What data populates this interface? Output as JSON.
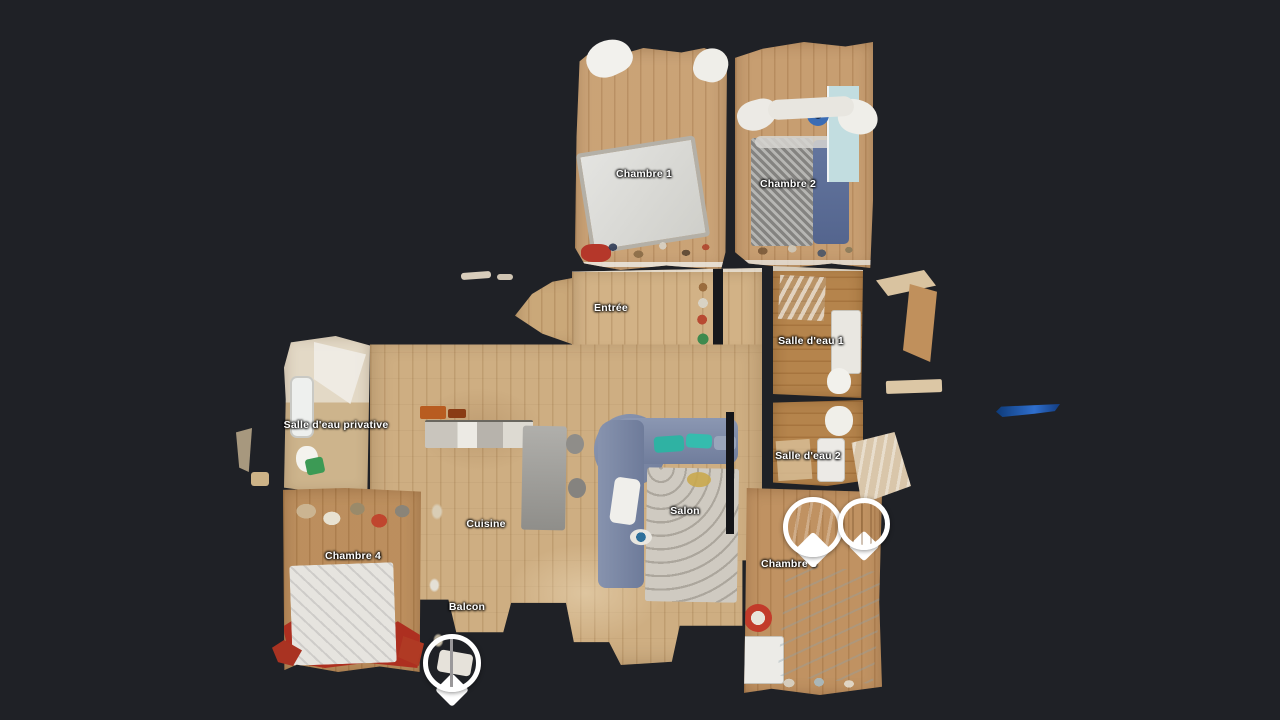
{
  "view": {
    "kind": "dollhouse-floorplan-3d-view",
    "background_color": "#1f2126"
  },
  "labels": [
    {
      "id": "chambre-1",
      "text": "Chambre 1"
    },
    {
      "id": "chambre-2",
      "text": "Chambre 2"
    },
    {
      "id": "entree",
      "text": "Entrée"
    },
    {
      "id": "salle-deau-1",
      "text": "Salle d'eau 1"
    },
    {
      "id": "salle-deau-privative",
      "text": "Salle d'eau privative"
    },
    {
      "id": "salle-deau-2",
      "text": "Salle d'eau 2"
    },
    {
      "id": "cuisine",
      "text": "Cuisine"
    },
    {
      "id": "salon",
      "text": "Salon"
    },
    {
      "id": "chambre-4",
      "text": "Chambre 4"
    },
    {
      "id": "chambre-3",
      "text": "Chambre 3"
    },
    {
      "id": "balcon",
      "text": "Balcon"
    }
  ],
  "markers": {
    "icon": "map-pin-marker",
    "ring_color": "#ffffff",
    "items": [
      {
        "id": "pin-chambre-3-a",
        "location": "chambre-3"
      },
      {
        "id": "pin-chambre-3-b",
        "location": "chambre-3"
      },
      {
        "id": "pin-balcon",
        "location": "balcon"
      }
    ]
  },
  "colors": {
    "background": "#1f2126",
    "wood_light": "#cfae80",
    "wood_bathroom": "#b27f45",
    "label_text": "#ffffff",
    "sofa": "#7d89a6",
    "cushion_teal": "#2fb2a3",
    "red_blanket": "#ad2f20",
    "artifact_blue": "#2f6fce"
  }
}
